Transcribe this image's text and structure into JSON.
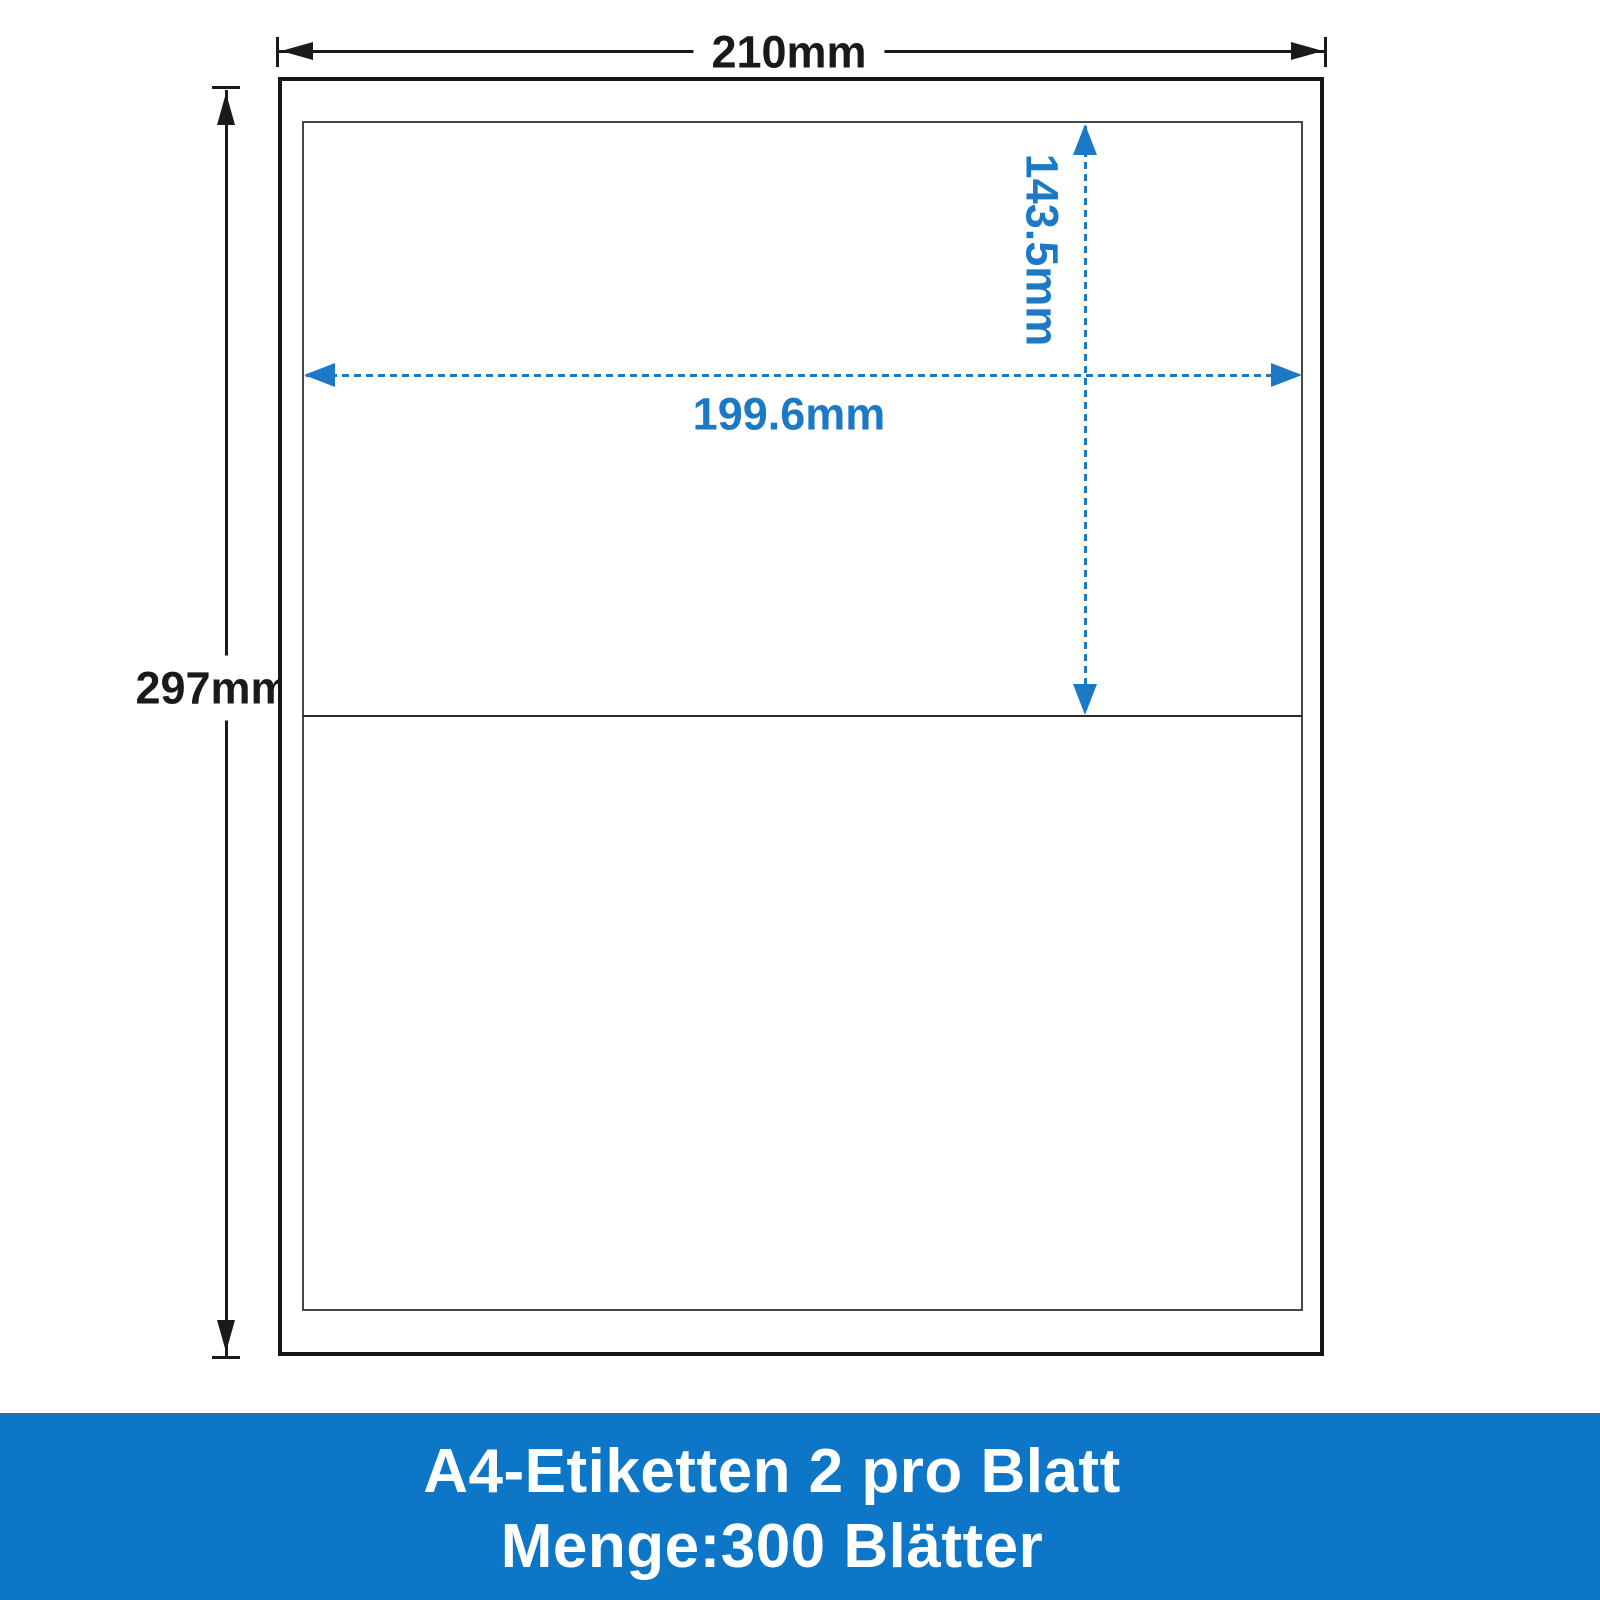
{
  "dimensions": {
    "sheet_width": "210mm",
    "sheet_height": "297mm",
    "label_width": "199.6mm",
    "label_height": "143.5mm"
  },
  "banner": {
    "line1": "A4-Etiketten 2 pro Blatt",
    "line2": "Menge:300 Blätter"
  },
  "colors": {
    "dimension_black": "#1a1a1a",
    "dimension_blue": "#1b79c6",
    "banner_background": "#0d76c6",
    "banner_text": "#ffffff"
  }
}
